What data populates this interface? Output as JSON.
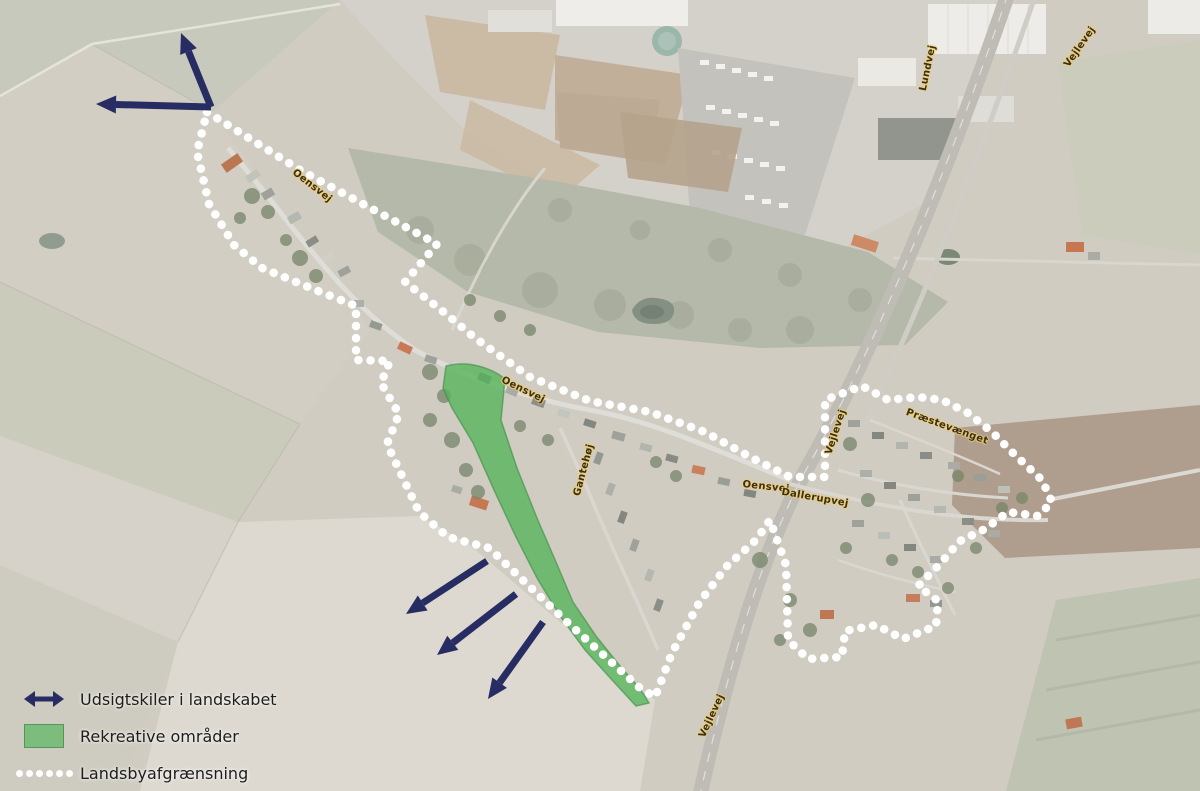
{
  "map": {
    "type": "aerial-village-plan",
    "colors": {
      "boundary_dots": "#ffffff",
      "view_arrow": "#272c63",
      "recreational_fill": "#57b45b",
      "recreational_border": "#3c8a44"
    },
    "annotations": {
      "top_left_view_arrows": 2,
      "bottom_view_arrows": 3
    }
  },
  "legend": {
    "items": [
      {
        "id": "view-corridors",
        "symbol": "double-arrow",
        "label": "Udsigtskiler i landskabet"
      },
      {
        "id": "recreational-areas",
        "symbol": "green-area",
        "label": "Rekreative områder"
      },
      {
        "id": "village-boundary",
        "symbol": "dotted-line",
        "label": "Landsbyafgrænsning"
      }
    ]
  },
  "road_labels": [
    {
      "id": "oensvej-northwest",
      "text": "Oensvej"
    },
    {
      "id": "oensvej-center",
      "text": "Oensvej"
    },
    {
      "id": "oensvej-junction",
      "text": "Oensvej"
    },
    {
      "id": "dallerupvej",
      "text": "Dallerupvej"
    },
    {
      "id": "praestevaenget",
      "text": "Præstevænget"
    },
    {
      "id": "gantehoej",
      "text": "Gantehøj"
    },
    {
      "id": "lundvej",
      "text": "Lundvej"
    },
    {
      "id": "vejlevej-north",
      "text": "Vejlevej"
    },
    {
      "id": "vejlevej-mid",
      "text": "Vejlevej"
    },
    {
      "id": "vejlevej-south",
      "text": "Vejlevej"
    }
  ]
}
